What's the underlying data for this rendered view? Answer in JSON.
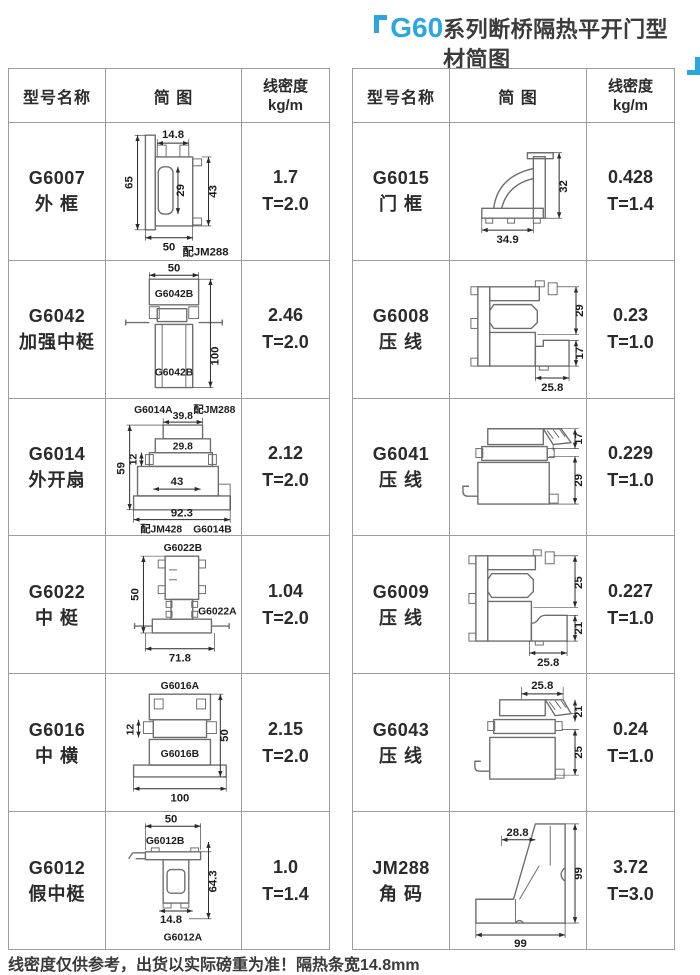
{
  "title": {
    "highlight": "G60",
    "text": "系列断桥隔热平开门型材简图"
  },
  "colors": {
    "accent": "#2BA7DE",
    "table_border": "#9C9C9C",
    "ink": "#2B2B2B",
    "profile_line": "#6E6E6E"
  },
  "header": {
    "model": "型号名称",
    "diagram": "简 图",
    "density_line1": "线密度",
    "density_line2": "kg/m"
  },
  "footer": "线密度仅供参考，出货以实际磅重为准！隔热条宽14.8mm",
  "left_rows": [
    {
      "model": "G6007",
      "name": "外 框",
      "density": "1.7",
      "thickness": "T=2.0",
      "dims": {
        "top": "14.8",
        "left": "65",
        "mid": "29",
        "right": "43",
        "bottom": "50",
        "note": "配JM288"
      }
    },
    {
      "model": "G6042",
      "name": "加强中梃",
      "density": "2.46",
      "thickness": "T=2.0",
      "dims": {
        "top": "50",
        "label_top": "G6042B",
        "right": "100",
        "label_bottom": "G6042B"
      }
    },
    {
      "model": "G6014",
      "name": "外开扇",
      "density": "2.12",
      "thickness": "T=2.0",
      "dims": {
        "label_tl": "G6014A",
        "top": "39.8",
        "note_tr": "配JM288",
        "inner_top": "29.8",
        "left_small": "12",
        "left": "59",
        "mid": "43",
        "bottom": "92.3",
        "note_bl": "配JM428",
        "label_br": "G6014B"
      }
    },
    {
      "model": "G6022",
      "name": "中 梃",
      "density": "1.04",
      "thickness": "T=2.0",
      "dims": {
        "label_top": "G6022B",
        "left": "50",
        "label_right": "G6022A",
        "bottom": "71.8"
      }
    },
    {
      "model": "G6016",
      "name": "中 横",
      "density": "2.15",
      "thickness": "T=2.0",
      "dims": {
        "label_top": "G6016A",
        "left_small": "12",
        "right": "50",
        "label_inner": "G6016B",
        "bottom": "100"
      }
    },
    {
      "model": "G6012",
      "name": "假中梃",
      "density": "1.0",
      "thickness": "T=1.4",
      "dims": {
        "top": "50",
        "label_top": "G6012B",
        "right": "64.3",
        "inner_bottom": "14.8",
        "label_bottom": "G6012A"
      }
    }
  ],
  "right_rows": [
    {
      "model": "G6015",
      "name": "门 框",
      "density": "0.428",
      "thickness": "T=1.4",
      "dims": {
        "right": "32",
        "bottom": "34.9"
      }
    },
    {
      "model": "G6008",
      "name": "压 线",
      "density": "0.23",
      "thickness": "T=1.0",
      "dims": {
        "right_top": "29",
        "right_bottom": "17",
        "bottom": "25.8"
      }
    },
    {
      "model": "G6041",
      "name": "压 线",
      "density": "0.229",
      "thickness": "T=1.0",
      "dims": {
        "right_top": "17",
        "right_bottom": "29"
      }
    },
    {
      "model": "G6009",
      "name": "压 线",
      "density": "0.227",
      "thickness": "T=1.0",
      "dims": {
        "right_top": "25",
        "right_bottom": "21",
        "bottom": "25.8"
      }
    },
    {
      "model": "G6043",
      "name": "压 线",
      "density": "0.24",
      "thickness": "T=1.0",
      "dims": {
        "top": "25.8",
        "right_top": "21",
        "right_bottom": "25"
      }
    },
    {
      "model": "JM288",
      "name": "角 码",
      "density": "3.72",
      "thickness": "T=3.0",
      "dims": {
        "top": "28.8",
        "right": "99",
        "bottom": "99"
      }
    }
  ]
}
